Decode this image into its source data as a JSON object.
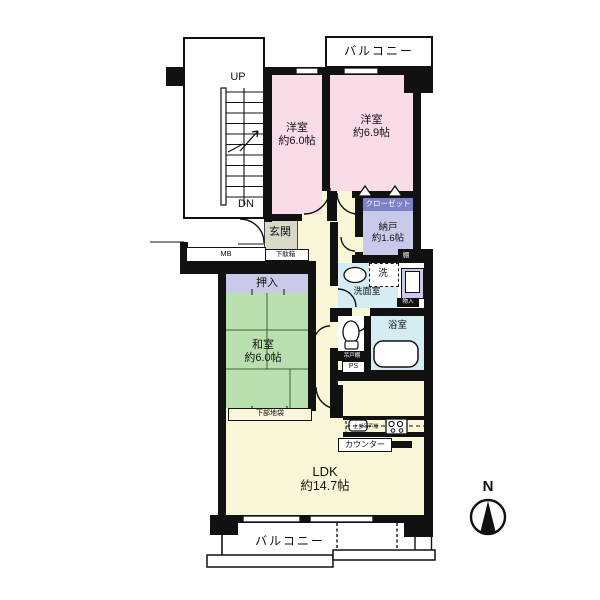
{
  "compass": "N",
  "balconies": {
    "top": "バルコニー",
    "bottom": "バルコニー"
  },
  "stairwell": {
    "up": "UP",
    "down": "DN"
  },
  "rooms": {
    "bedroom1": {
      "name": "洋室",
      "size": "約6.0帖"
    },
    "bedroom2": {
      "name": "洋室",
      "size": "約6.9帖"
    },
    "closet": "クローゼット",
    "storeroom": {
      "name": "納戸",
      "size": "約1.6帖"
    },
    "entrance": "玄関",
    "japanese_room": {
      "name": "和室",
      "size": "約6.0帖"
    },
    "ldk": {
      "name": "LDK",
      "size": "約14.7帖"
    },
    "washroom": "洗面室",
    "bathroom": "浴室"
  },
  "fixtures": {
    "shoe_cabinet": "下駄箱",
    "meter_box": "MB",
    "shelf": "棚",
    "oshiire": "押入",
    "lower_cabinet": "下部地袋",
    "washer": "洗",
    "small_storage": "物入",
    "hanging_cupboard": "吊戸棚",
    "pipe_space": "PS",
    "upper_cupboard": "上部吊戸棚",
    "counter": "カウンター"
  },
  "colors": {
    "wall": "#111111",
    "western_room": "#f9dce8",
    "closet_fill": "#c9c9ea",
    "closet_band": "#7d82c8",
    "japanese_room": "#b9e0ae",
    "hall": "#faf6d8",
    "wet_area": "#d5ecf2",
    "entrance_fill": "#d9d9ca"
  }
}
